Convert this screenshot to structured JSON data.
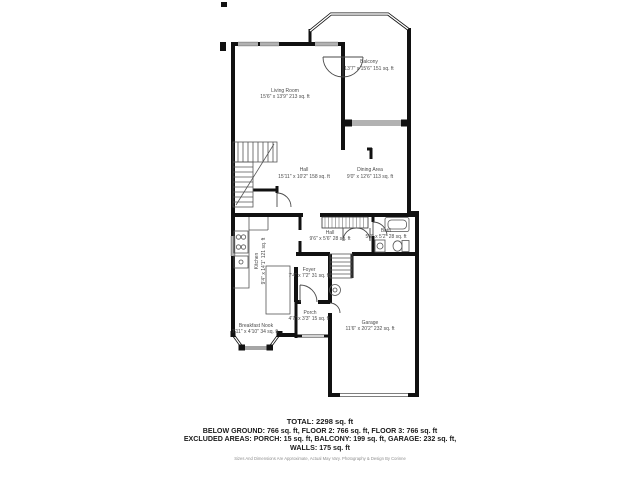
{
  "floor_plan": {
    "rooms": {
      "living_room": {
        "name": "Living Room",
        "dims": "15'6\" x 13'9\" 213 sq. ft"
      },
      "balcony": {
        "name": "Balcony",
        "dims": "13'7\" x 15'6\" 151 sq. ft"
      },
      "hall_upper": {
        "name": "Hall",
        "dims": "15'11\" x 10'2\" 158 sq. ft"
      },
      "dining_area": {
        "name": "Dining Area",
        "dims": "9'0\" x 12'6\" 113 sq. ft"
      },
      "hall_lower": {
        "name": "Hall",
        "dims": "9'6\" x 5'6\" 28 sq. ft"
      },
      "bath": {
        "name": "Bath",
        "dims": "5'2\" x 5'2\" 28 sq. ft"
      },
      "kitchen": {
        "name": "Kitchen",
        "dims": "9'4\" x 14'1\" 121 sq. ft"
      },
      "foyer": {
        "name": "Foyer",
        "dims": "7'4\" x 7'2\" 31 sq. ft"
      },
      "porch": {
        "name": "Porch",
        "dims": "4'7\" x 3'3\" 15 sq. ft"
      },
      "breakfast_nook": {
        "name": "Breakfast Nook",
        "dims": "7'11\" x 4'10\" 34 sq. ft"
      },
      "garage": {
        "name": "Garage",
        "dims": "11'6\" x 20'2\" 232 sq. ft"
      }
    },
    "colors": {
      "wall": "#111111",
      "thin_line": "#4a4a4a",
      "label": "#4c4c4c"
    }
  },
  "summary": {
    "total": "TOTAL: 2298 sq. ft",
    "line2": "BELOW GROUND: 766 sq. ft, FLOOR 2: 766 sq. ft, FLOOR 3: 766 sq. ft",
    "line3": "EXCLUDED AREAS: PORCH: 15 sq. ft, BALCONY: 199 sq. ft, GARAGE: 232 sq. ft,",
    "line4": "WALLS: 175 sq. ft",
    "disclaimer": "Sizes And Dimensions Are Approximate, Actual May Vary. Photography & Design By Corinne"
  }
}
